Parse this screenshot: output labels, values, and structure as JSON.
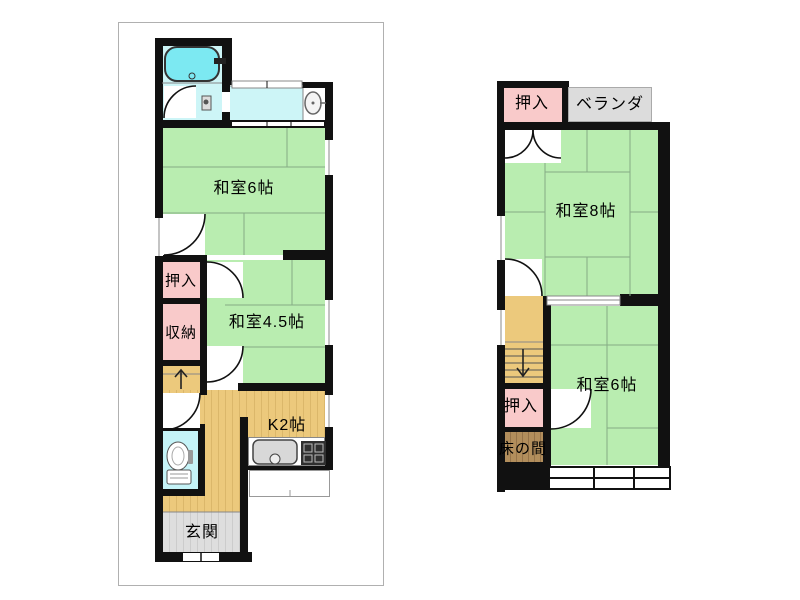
{
  "palette": {
    "wall": "#111111",
    "tatami_green": "#b9edb0",
    "tatami_line": "#85ac85",
    "closet_pink": "#f9caca",
    "water_cyan": "#cdf5f7",
    "bathtub_cyan": "#7ce9f2",
    "toilet_cyan": "#c5f3f7",
    "wood_tan": "#ecc97c",
    "entrance_gray": "#dedede",
    "veranda_gray": "#dcdcdc",
    "tokonoma_brown": "#b28e5c"
  },
  "floor1": {
    "labels": {
      "washitsu6": "和室6帖",
      "oshiire": "押入",
      "shunou": "収納",
      "washitsu45": "和室4.5帖",
      "kitchen": "K2帖",
      "genkan": "玄関"
    }
  },
  "floor2": {
    "labels": {
      "oshiire_top": "押入",
      "veranda": "ベランダ",
      "washitsu8": "和室8帖",
      "washitsu6": "和室6帖",
      "oshiire": "押入",
      "tokonoma": "床の間"
    }
  }
}
